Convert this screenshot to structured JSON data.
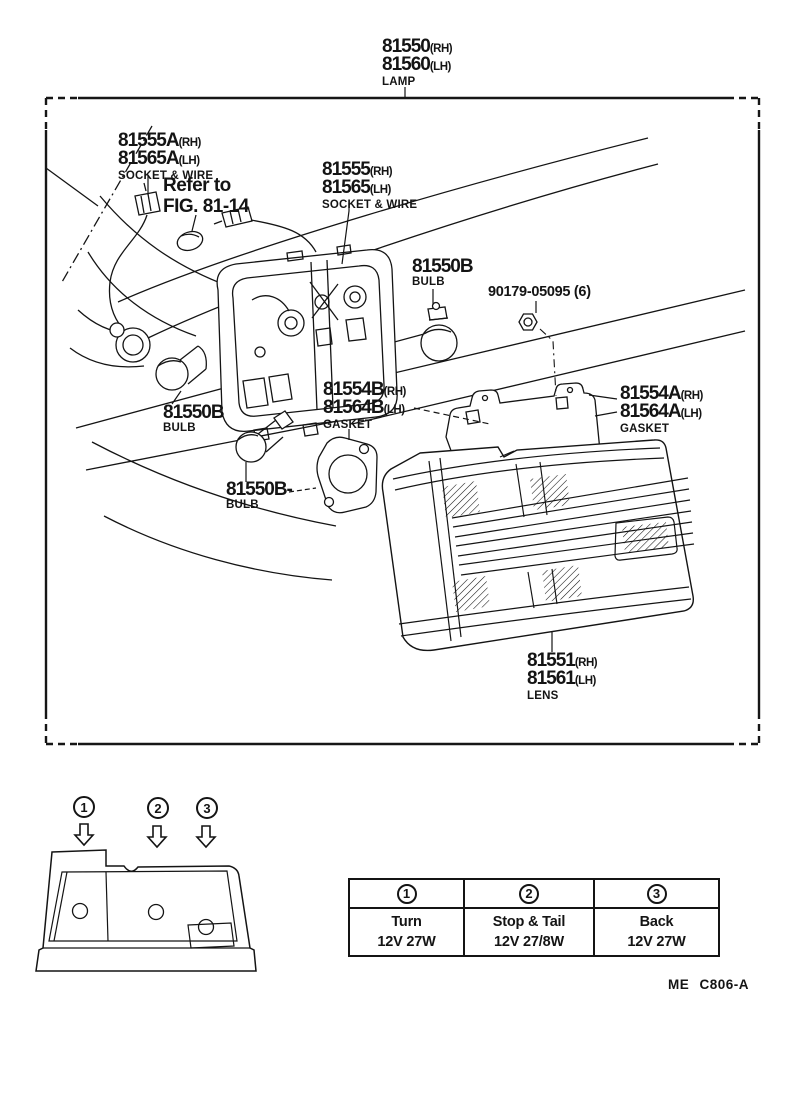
{
  "doc": {
    "footer_code": "ME C806-A"
  },
  "parts": {
    "lamp": {
      "num_rh": "81550",
      "suf_rh": "(RH)",
      "num_lh": "81560",
      "suf_lh": "(LH)",
      "desc": "LAMP"
    },
    "socket_wire_a": {
      "num_rh": "81555A",
      "suf_rh": "(RH)",
      "num_lh": "81565A",
      "suf_lh": "(LH)",
      "desc": "SOCKET & WIRE"
    },
    "refer_note": {
      "line1": "Refer to",
      "line2": "FIG. 81-14"
    },
    "socket_wire": {
      "num_rh": "81555",
      "suf_rh": "(RH)",
      "num_lh": "81565",
      "suf_lh": "(LH)",
      "desc": "SOCKET & WIRE"
    },
    "bulb_top": {
      "num": "81550B",
      "desc": "BULB"
    },
    "nut": {
      "num": "90179-05095 (6)"
    },
    "bulb_left": {
      "num": "81550B",
      "desc": "BULB"
    },
    "bulb_mid": {
      "num": "81550B-",
      "desc": "BULB"
    },
    "gasket_b": {
      "num_rh": "81554B",
      "suf_rh": "(RH)",
      "num_lh": "81564B",
      "suf_lh": "(LH)",
      "desc": "GASKET"
    },
    "gasket_a": {
      "num_rh": "81554A",
      "suf_rh": "(RH)",
      "num_lh": "81564A",
      "suf_lh": "(LH)",
      "desc": "GASKET"
    },
    "lens": {
      "num_rh": "81551",
      "suf_rh": "(RH)",
      "num_lh": "81561",
      "suf_lh": "(LH)",
      "desc": "LENS"
    }
  },
  "inset": {
    "callouts": [
      {
        "symbol": "1"
      },
      {
        "symbol": "2"
      },
      {
        "symbol": "3"
      }
    ]
  },
  "legend_table": {
    "columns": [
      {
        "symbol": "1",
        "name": "Turn",
        "spec": "12V 27W"
      },
      {
        "symbol": "2",
        "name": "Stop & Tail",
        "spec": "12V 27/8W"
      },
      {
        "symbol": "3",
        "name": "Back",
        "spec": "12V 27W"
      }
    ]
  },
  "ink_color": "#141414"
}
